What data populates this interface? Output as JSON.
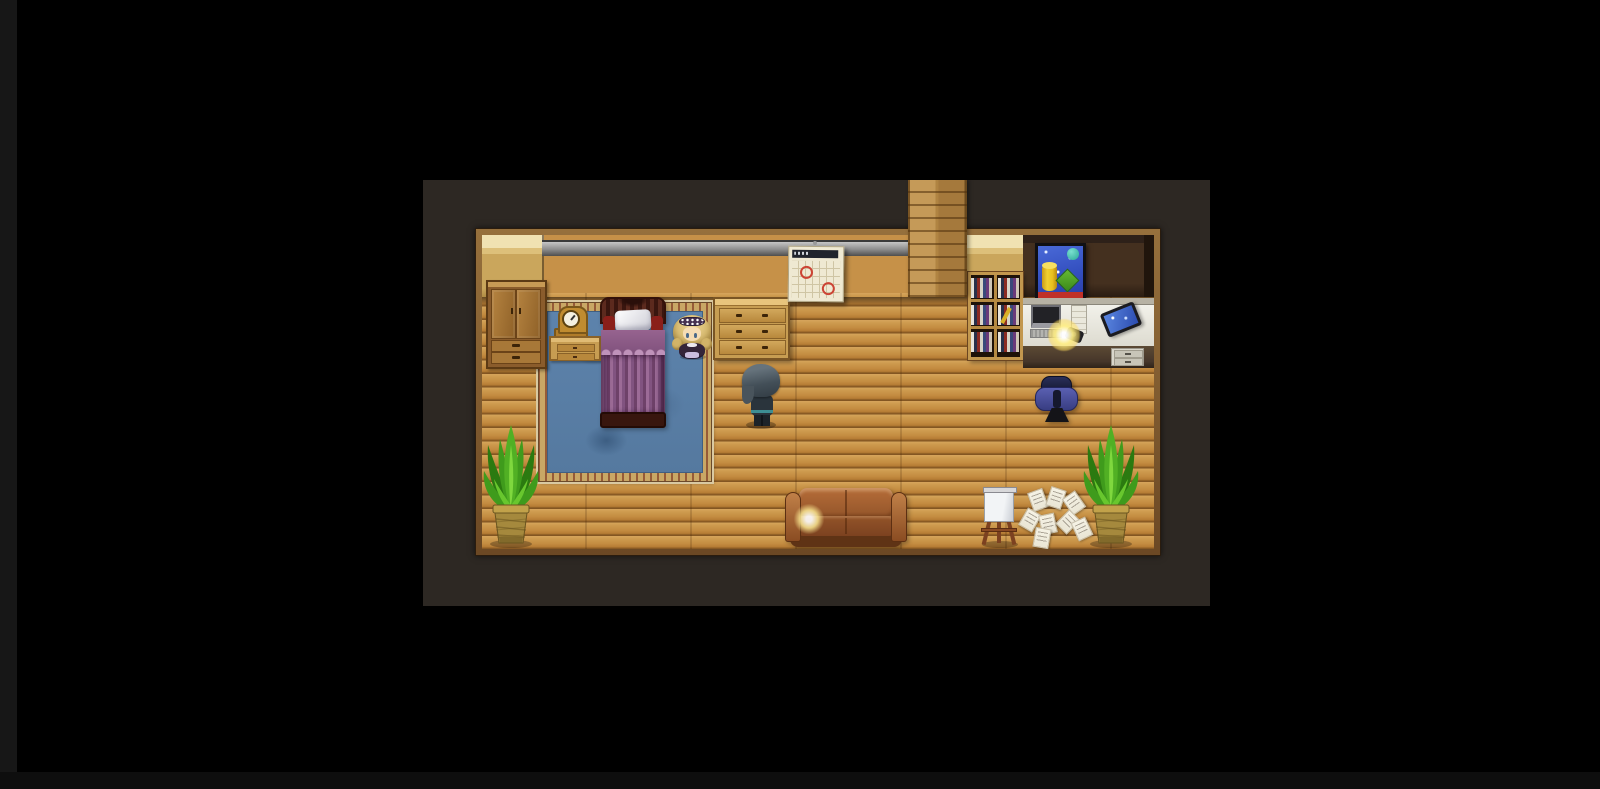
{
  "window": {
    "width": 1600,
    "height": 789,
    "background": "black letterbox around centered game view"
  },
  "viewport": {
    "x": 423,
    "y": 180,
    "width": 787,
    "height": 426,
    "label": "RPG Maker style top-down game viewport"
  },
  "scene": {
    "setting": "Wooden interior room combining a bedroom area and a study/office area",
    "characters": {
      "player": {
        "label": "Player character with dark teal bob hair facing right, standing mid-room"
      },
      "npc_girl": {
        "label": "Blonde curly-haired girl NPC with dark dress and lace headband beside the bed"
      }
    },
    "objects": {
      "chimney": {
        "label": "Vertical wooden wall column extending from top of screen to floor"
      },
      "wardrobe": {
        "label": "Brown two-door wardrobe with two drawers, left wall"
      },
      "clock": {
        "label": "Golden mantel clock on nightstand"
      },
      "nightstand": {
        "label": "Tan nightstand with two drawers left of bed"
      },
      "bed": {
        "label": "Single bed with dark ornate headboard, white pillow, red side cushions and ruffled purple striped blanket"
      },
      "rug": {
        "label": "Large blue rug with ornate tan stitched border under the bed"
      },
      "dresser": {
        "label": "Tan chest of drawers right of the bed, three drawer rows"
      },
      "calendar": {
        "label": "Wall calendar with dark header and two dates circled in red",
        "marked_days": 2
      },
      "bookshelf": {
        "label": "Glass-front wooden bookshelf filled with colored books, one yellow book leaning"
      },
      "painting": {
        "label": "Black-framed abstract still-life poster: yellow cylinder, green cube, teal orb on starry blue"
      },
      "desk": {
        "label": "White office desk with monitor, keyboard, glowing lamp, white tower, black handset and wall tablet; grey drawer pedestal"
      },
      "monitor": {
        "label": "Dark computer monitor on desk"
      },
      "desk_lamp": {
        "label": "Glowing yellow desk lamp"
      },
      "tablet": {
        "label": "Tilted wall-mounted tablet with blue screen"
      },
      "office_chair": {
        "label": "Navy-blue office chair seen from behind"
      },
      "couch": {
        "label": "Brown leather two-seat couch with light reflection on left cushion"
      },
      "easel": {
        "label": "Wooden easel holding a blank white canvas"
      },
      "papers": {
        "label": "Scattered white pages with writing on the floor",
        "count": 8
      },
      "plant_left": {
        "label": "Potted leafy plant in woven pot, bottom-left corner"
      },
      "plant_right": {
        "label": "Potted leafy plant in woven pot, bottom-right corner"
      }
    }
  },
  "palette": {
    "page-bg": "#000000",
    "edge": "#171717",
    "viewport-bg": "#2d2823",
    "frame-light": "#96703c",
    "frame-dark": "#6b4824",
    "floor-light": "#d6a55c",
    "floor-mid": "#c69148",
    "floor-groove": "#8f5f26",
    "wall-tan": "#caa65c",
    "wall-dark": "#3e2a1f",
    "wall-rail-grey": "#8a8a8a",
    "rug-blue": "#5d83ac",
    "rug-border": "#c9a765",
    "bed-purple": "#815380",
    "headboard": "#4a211a",
    "furniture-tan": "#c79d52",
    "couch-brown": "#93552a",
    "chair-blue": "#4a4f9b",
    "plant-green": "#3f9b1c",
    "pot-tan": "#a5893d",
    "painting-blue": "#3450c0",
    "lamp-glow": "#ffee82",
    "calendar-mark": "#cc4434"
  }
}
